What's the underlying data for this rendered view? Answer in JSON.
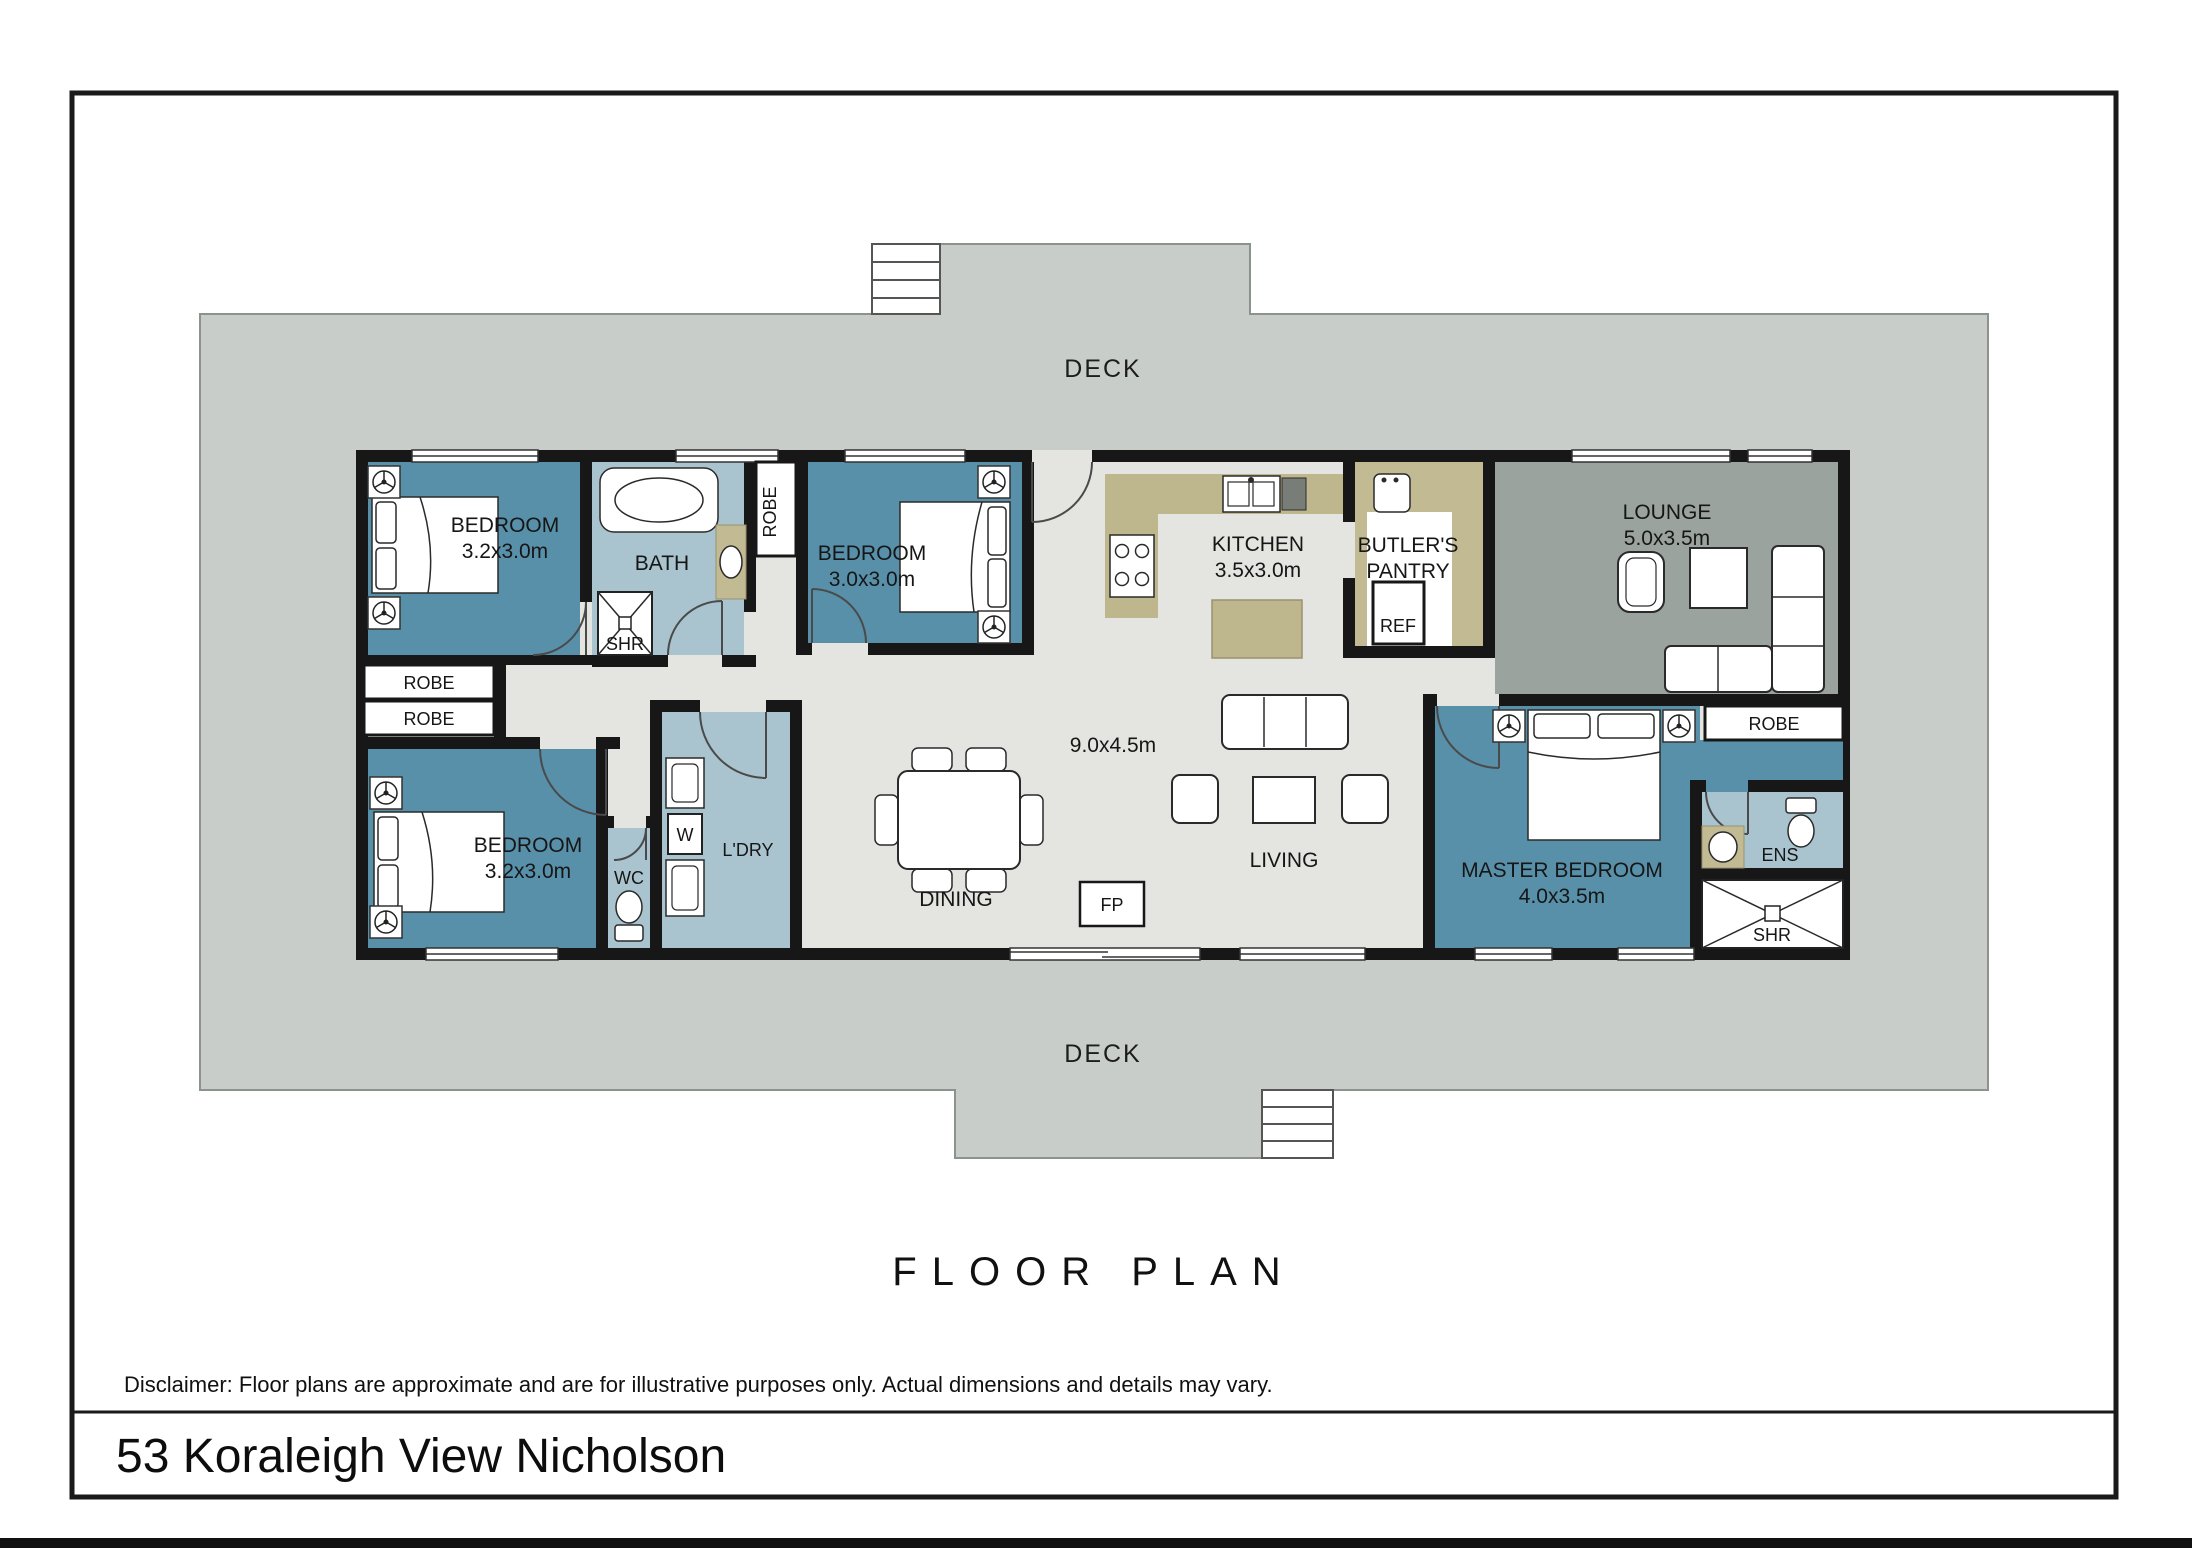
{
  "colors": {
    "deck": "#c9cdc9",
    "deck-outline": "#8c928c",
    "floor": "#e4e5e1",
    "wall": "#171717",
    "bedroom": "#5890aa",
    "wet": "#a9c4ce",
    "lounge": "#9ba39e",
    "bench": "#beb68c",
    "accent-tan": "#c1ba92"
  },
  "page": {
    "floor_plan_title": "FLOOR PLAN",
    "disclaimer": "Disclaimer: Floor plans are approximate and are for illustrative purposes only. Actual dimensions and details may vary.",
    "address": "53 Koraleigh View Nicholson"
  },
  "deck": {
    "top_label": "DECK",
    "bottom_label": "DECK"
  },
  "rooms": {
    "bedroom1": {
      "name": "BEDROOM",
      "dim": "3.2x3.0m"
    },
    "bath": {
      "name": "BATH"
    },
    "bath_shower": {
      "name": "SHR"
    },
    "robe_hall": {
      "name": "ROBE"
    },
    "bedroom2": {
      "name": "BEDROOM",
      "dim": "3.0x3.0m"
    },
    "kitchen": {
      "name": "KITCHEN",
      "dim": "3.5x3.0m"
    },
    "butlers_pantry": {
      "line1": "BUTLER'S",
      "line2": "PANTRY"
    },
    "fridge": {
      "name": "REF"
    },
    "lounge": {
      "name": "LOUNGE",
      "dim": "5.0x3.5m"
    },
    "robe1": {
      "name": "ROBE"
    },
    "robe2": {
      "name": "ROBE"
    },
    "bedroom3": {
      "name": "BEDROOM",
      "dim": "3.2x3.0m"
    },
    "wc": {
      "name": "WC"
    },
    "laundry": {
      "name": "L'DRY"
    },
    "washer": {
      "name": "W"
    },
    "dining": {
      "name": "DINING"
    },
    "open_plan_dim": "9.0x4.5m",
    "living": {
      "name": "LIVING"
    },
    "fireplace": {
      "name": "FP"
    },
    "master": {
      "name": "MASTER BEDROOM",
      "dim": "4.0x3.5m"
    },
    "robe_master": {
      "name": "ROBE"
    },
    "ensuite": {
      "name": "ENS"
    },
    "ens_shower": {
      "name": "SHR"
    }
  }
}
